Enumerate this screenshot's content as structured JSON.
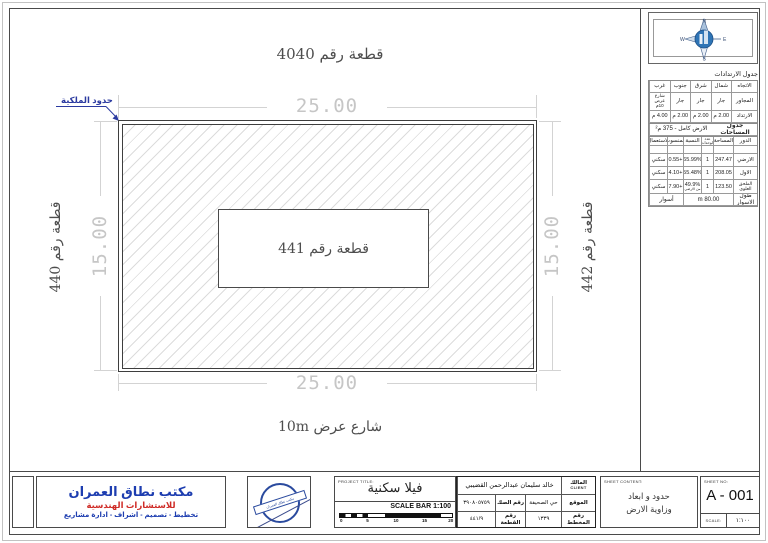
{
  "colors": {
    "accent_blue": "#2b3aa0",
    "brand_blue": "#1d3db0",
    "brand_red": "#cf2b26",
    "dim_gray": "#c6c6c6",
    "line_dark": "#3e3e3e",
    "stamp_blue": "#2a4a9e",
    "globe_blue": "#2e74b5"
  },
  "drawing": {
    "plot_top_label": "قطعة رقم 4040",
    "plot_center_label": "قطعة رقم 441",
    "plot_left_label": "قطعة رقم 440",
    "plot_right_label": "قطعة رقم 442",
    "street_label": "شارع عرض 10m",
    "boundary_label": "حدود الملكية",
    "dim_width_top": "25.00",
    "dim_width_bottom": "25.00",
    "dim_height_left": "15.00",
    "dim_height_right": "15.00"
  },
  "compass": {
    "north": "N",
    "south": "S",
    "east": "E",
    "west": "W"
  },
  "setbacks": {
    "title": "جدول الارتدادات",
    "direction_label": "الاتجاه",
    "neighbor_label": "المجاور",
    "setback_label": "الارتداد",
    "directions": [
      "شمال",
      "شرق",
      "جنوب",
      "غرب"
    ],
    "neighbors": [
      "جار",
      "جار",
      "جار",
      "شارع عرض 10م"
    ],
    "values": [
      "2.00 م",
      "2.00 م",
      "2.00 م",
      "4.00 م"
    ]
  },
  "areas": {
    "title": "جدول المساحات",
    "total_label": "الارض كامل",
    "total_value": "375 م²"
  },
  "floors": {
    "headers": [
      "الدور",
      "المساحة",
      "عدد الوحدات",
      "النسبة",
      "المنسوب",
      "الاستعمال"
    ],
    "rows": [
      {
        "floor": "الارضي",
        "area": "247.47",
        "units": "1",
        "ratio": "65.99%",
        "level": "+0.55",
        "use": "سكني"
      },
      {
        "floor": "الاول",
        "area": "208.05",
        "units": "1",
        "ratio": "55.48%",
        "level": "+4.10",
        "use": "سكني"
      },
      {
        "floor": "الملحق العلوي",
        "area": "123.50",
        "units": "1",
        "ratio": "49.9%",
        "ratio_note": "من الارضي",
        "level": "+7.90",
        "use": "سكني"
      }
    ],
    "fence_label": "طول الاسوار",
    "fence_value": "80.00 m",
    "fence_use": "أسوار"
  },
  "titleblock": {
    "company": {
      "name": "مكتب نطاق العمران",
      "subtitle": "للاستشارات الهندسية",
      "services": "تخطيط - تصميم - اشراف - ادارة مشاريع"
    },
    "stamp_text": "مكتب نطاق العمران",
    "project": {
      "label": "PROJECT TITLE:",
      "title": "فيلا سكنية",
      "scalebar_label": "SCALE BAR 1:100",
      "scale_ticks": [
        "0",
        "5",
        "10",
        "15",
        "20"
      ]
    },
    "client": {
      "owner_label": "المالك",
      "owner_label_en": "CLIENT",
      "owner_name": "خالد سليمان عبدالرحمن القضيبي",
      "location_label": "الموقع",
      "location_value": "حي الصحيفة",
      "deed_label": "رقم الصك",
      "deed_value": "٣٩٠٨٠٥٧٥٩",
      "plan_label": "رقم المخطط",
      "plan_value": "١٣٣٩",
      "plot_label": "رقم القطعة",
      "plot_value": "٤٤١/٩"
    },
    "sheet": {
      "content_label": "SHEET CONTENT:",
      "content_line1": "حدود و ابعاد",
      "content_line2": "وزاوية الارض",
      "number_label": "SHEET NO:",
      "number": "A - 001",
      "scale_label": "SCALE:",
      "scale_value": "١:١٠٠"
    }
  }
}
